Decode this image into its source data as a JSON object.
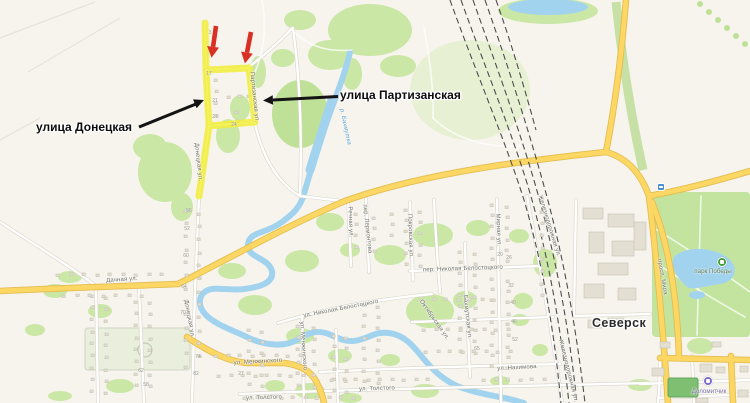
{
  "map": {
    "city": "Северск",
    "annotations": {
      "donetska": "улица Донецкая",
      "partizanska": "улица Партизанская"
    },
    "street_labels": [
      {
        "text": "Дачная ул.",
        "x": 122,
        "y": 280,
        "rot": -4
      },
      {
        "text": "Донецкая ул.",
        "x": 189,
        "y": 319,
        "rot": 80
      },
      {
        "text": "Донецкая ул.",
        "x": 198,
        "y": 162,
        "rot": 84
      },
      {
        "text": "Партизанская ул.",
        "x": 254,
        "y": 97,
        "rot": 84
      },
      {
        "text": "Речная ул.",
        "x": 350,
        "y": 222,
        "rot": 88
      },
      {
        "text": "пер. Лермонтова",
        "x": 367,
        "y": 229,
        "rot": 84
      },
      {
        "text": "Покровская ул.",
        "x": 410,
        "y": 236,
        "rot": 88
      },
      {
        "text": "Мирная ул.",
        "x": 498,
        "y": 230,
        "rot": 88
      },
      {
        "text": "пер. Николая Белостоцкого",
        "x": 463,
        "y": 269,
        "rot": -2
      },
      {
        "text": "ул. Николая Белостоцкого",
        "x": 341,
        "y": 309,
        "rot": -11
      },
      {
        "text": "ул. Менжинского",
        "x": 258,
        "y": 362,
        "rot": -3
      },
      {
        "text": "ул. Менжинского",
        "x": 303,
        "y": 346,
        "rot": 86
      },
      {
        "text": "ул. Нахимова",
        "x": 517,
        "y": 368,
        "rot": -3
      },
      {
        "text": "ул. Толстого",
        "x": 377,
        "y": 389,
        "rot": -2
      },
      {
        "text": "ул. Толстого",
        "x": 264,
        "y": 398,
        "rot": -2
      },
      {
        "text": "Октябрьская ул.",
        "x": 434,
        "y": 320,
        "rot": 55
      },
      {
        "text": "Бахмутская ул.",
        "x": 467,
        "y": 317,
        "rot": 84
      },
      {
        "text": "Железнодорожная ул.",
        "x": 549,
        "y": 226,
        "rot": 73
      },
      {
        "text": "Железнодорожная ул.",
        "x": 568,
        "y": 371,
        "rot": 76
      },
      {
        "text": "просп. Мира",
        "x": 662,
        "y": 277,
        "rot": 80
      },
      {
        "text": "р. Бахмутка",
        "x": 345,
        "y": 127,
        "rot": 78,
        "kind": "river"
      }
    ],
    "house_numbers": [
      {
        "t": "3",
        "x": 210,
        "y": 33
      },
      {
        "t": "17",
        "x": 209,
        "y": 74
      },
      {
        "t": "21",
        "x": 215,
        "y": 101
      },
      {
        "t": "27",
        "x": 215,
        "y": 117
      },
      {
        "t": "24",
        "x": 234,
        "y": 125
      },
      {
        "t": "56",
        "x": 189,
        "y": 211
      },
      {
        "t": "52",
        "x": 187,
        "y": 229
      },
      {
        "t": "60",
        "x": 186,
        "y": 256
      },
      {
        "t": "64",
        "x": 184,
        "y": 287
      },
      {
        "t": "70",
        "x": 183,
        "y": 313
      },
      {
        "t": "74",
        "x": 198,
        "y": 357
      },
      {
        "t": "82",
        "x": 196,
        "y": 374
      },
      {
        "t": "62",
        "x": 141,
        "y": 371
      },
      {
        "t": "58",
        "x": 146,
        "y": 385
      },
      {
        "t": "20",
        "x": 500,
        "y": 255
      },
      {
        "t": "26",
        "x": 509,
        "y": 258
      },
      {
        "t": "32",
        "x": 511,
        "y": 286
      },
      {
        "t": "40",
        "x": 513,
        "y": 303
      },
      {
        "t": "46",
        "x": 514,
        "y": 322
      },
      {
        "t": "52",
        "x": 515,
        "y": 340
      },
      {
        "t": "65",
        "x": 477,
        "y": 349
      },
      {
        "t": "27",
        "x": 241,
        "y": 374
      }
    ],
    "pois": [
      {
        "name": "парк Победы",
        "icon": "park-icon",
        "icon_x": 722,
        "icon_y": 262,
        "label_x": 713,
        "label_y": 268,
        "icon_color": "#44a13e",
        "label_color": "#5f7e58"
      },
      {
        "name": "Доломитчик",
        "icon": "sport-icon",
        "icon_x": 708,
        "icon_y": 381,
        "label_x": 709,
        "label_y": 388,
        "icon_color": "#7f68cb",
        "label_color": "#7d74a8"
      }
    ],
    "transport_stop": {
      "x": 661,
      "y": 187,
      "color": "#4a8fd3"
    }
  },
  "colors": {
    "land": "#f7f4ed",
    "green": "#cae7a6",
    "water": "#a2d3ee",
    "road_yellow": "#fcd763",
    "road_yellow_edge": "#e3bd52",
    "highlight": "#f2ee35",
    "arrow_red": "#d93025",
    "arrow_black": "#141414",
    "label_gray": "#6e6e66",
    "water_label": "#579fd0"
  }
}
